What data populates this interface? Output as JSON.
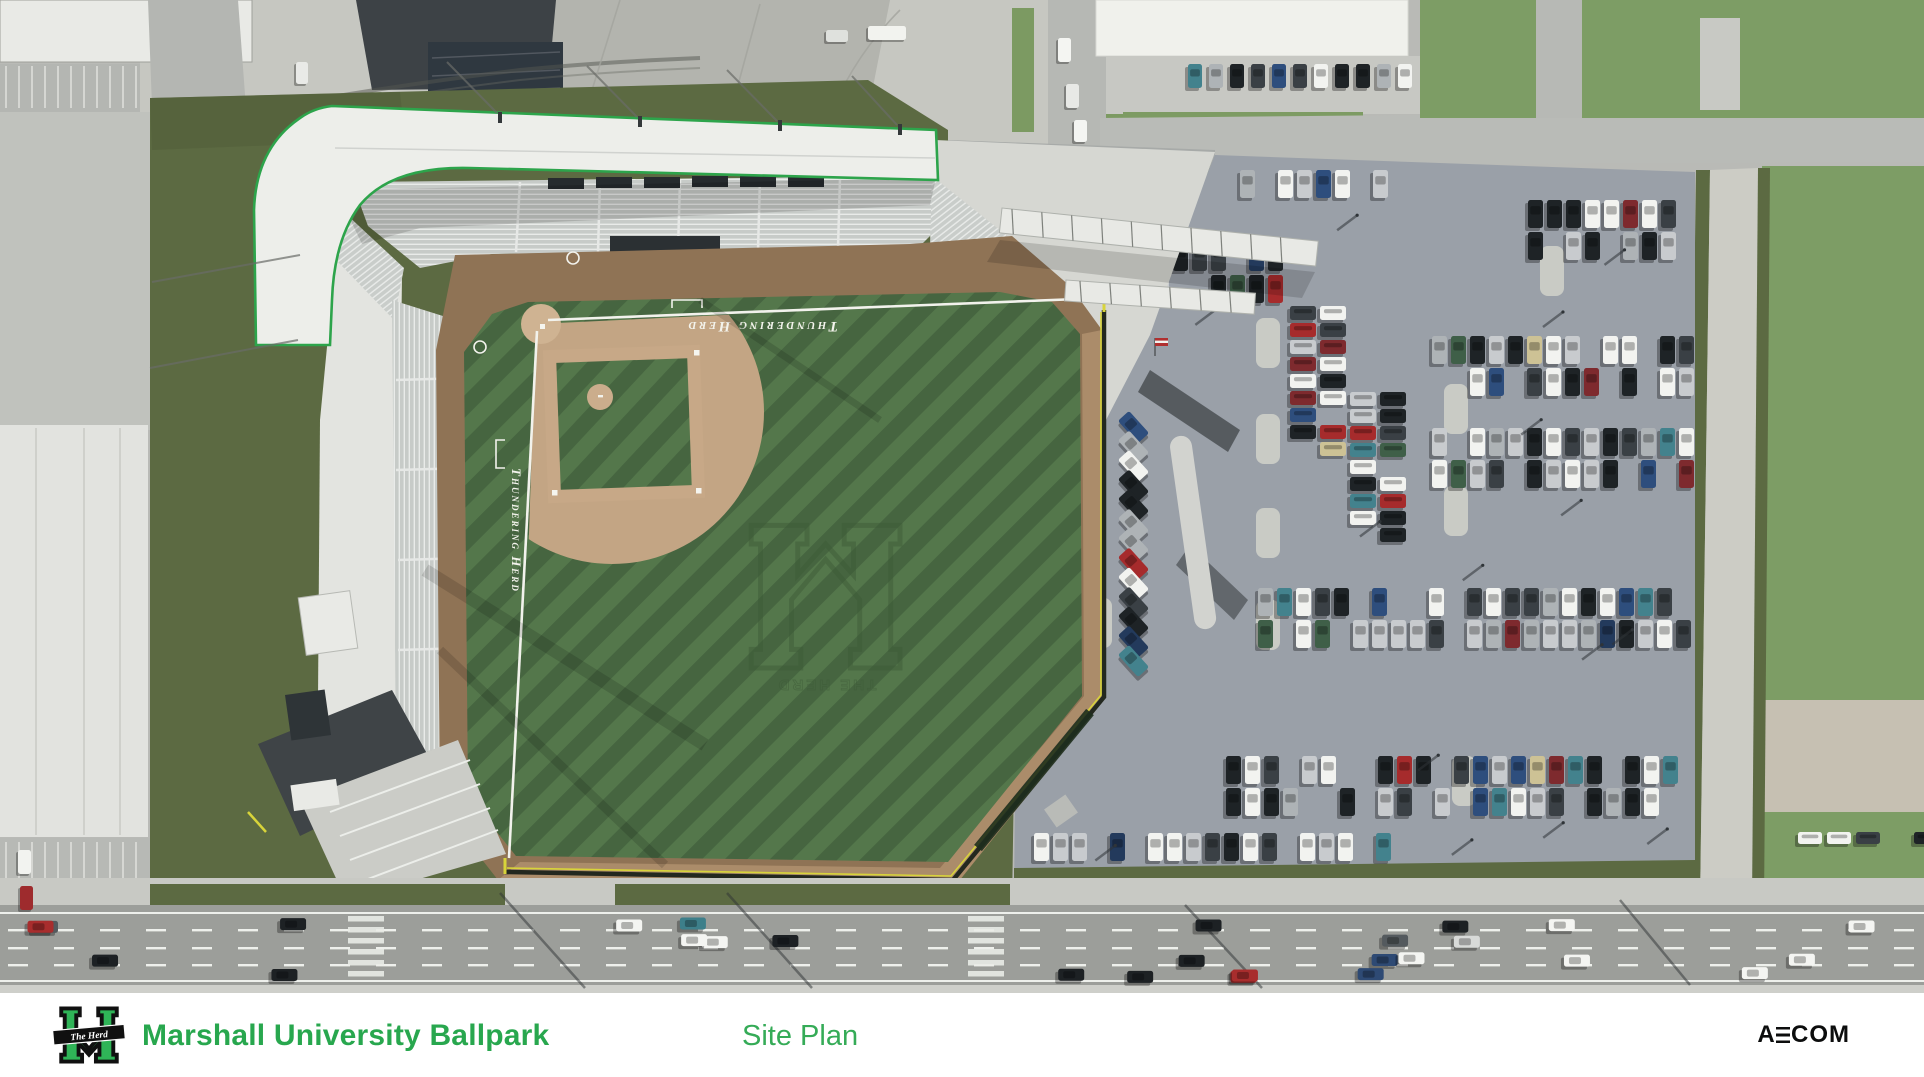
{
  "footer": {
    "title": "Marshall University Ballpark",
    "subtitle": "Site Plan",
    "brand_parts": [
      "A",
      "E",
      "COM"
    ],
    "logo_banner": "The Herd",
    "title_color": "#28a74e",
    "subtitle_color": "#35ab57",
    "brand_color": "#0c0d0d",
    "background": "#ffffff"
  },
  "field_texts": {
    "backstop": "Thundering Herd",
    "third_base_line": "Thundering Herd",
    "outfield_logo": "THE HERD"
  },
  "colors": {
    "accent_green": "#2da44b",
    "turf_light": "#54774b",
    "turf_dark": "#466540",
    "infield_dirt": "#c5a686",
    "warning_track": "#8f7355",
    "site_olive": "#5c6a42",
    "lot_asphalt": "#9aa0a8",
    "roof_white": "#edeeea",
    "photo_concrete": "#c6c7c1",
    "lawn": "#7d9d65",
    "fence_yellow": "#d8d43a"
  },
  "parking": {
    "bands": [
      {
        "x0": 1240,
        "x1": 1392,
        "y": 170,
        "rows": [
          0
        ]
      },
      {
        "x0": 1528,
        "x1": 1694,
        "y": 200,
        "rows": [
          0,
          32
        ]
      },
      {
        "x0": 1078,
        "x1": 1296,
        "y": 243,
        "rows": [
          0,
          32
        ]
      },
      {
        "x0": 1432,
        "x1": 1694,
        "y": 336,
        "rows": [
          0,
          32
        ]
      },
      {
        "x0": 1432,
        "x1": 1694,
        "y": 428,
        "rows": [
          0,
          32
        ]
      },
      {
        "x0": 1258,
        "x1": 1694,
        "y": 588,
        "rows": [
          0,
          32
        ]
      },
      {
        "x0": 1226,
        "x1": 1694,
        "y": 756,
        "rows": [
          0,
          32
        ]
      },
      {
        "x0": 1034,
        "x1": 1392,
        "y": 833,
        "rows": [
          0
        ]
      }
    ],
    "columns": [
      {
        "x": 1290,
        "y0": 306,
        "y1": 472
      },
      {
        "x": 1320,
        "y0": 306,
        "y1": 472
      },
      {
        "x": 1350,
        "y0": 392,
        "y1": 558
      },
      {
        "x": 1380,
        "y0": 392,
        "y1": 558
      }
    ],
    "apron_row": {
      "x0": 1188,
      "x1": 1398,
      "y": 64
    },
    "right_street_row": {
      "x0": 1798,
      "x1": 1914,
      "y": 832
    },
    "angled_row": {
      "x": 1126,
      "y0": 412,
      "count": 13,
      "step": 19.5,
      "angle": -42
    },
    "pads": [
      [
        1256,
        318
      ],
      [
        1256,
        414
      ],
      [
        1256,
        508
      ],
      [
        1444,
        384
      ],
      [
        1444,
        486
      ],
      [
        1088,
        236
      ],
      [
        1540,
        246
      ],
      [
        1452,
        756
      ],
      [
        1256,
        600
      ],
      [
        1088,
        598
      ]
    ],
    "pole_shadow_count": 16,
    "occupancy": 0.82,
    "palette": [
      [
        "#f2f3f0",
        6
      ],
      [
        "#c8cbce",
        3
      ],
      [
        "#aeb3b6",
        2
      ],
      [
        "#1e2326",
        4
      ],
      [
        "#3a4045",
        2
      ],
      [
        "#a62b2c",
        1
      ],
      [
        "#7e2a2e",
        1
      ],
      [
        "#43828d",
        1.2
      ],
      [
        "#2e4e7d",
        1
      ],
      [
        "#233a5c",
        1
      ],
      [
        "#cdc295",
        0.6
      ],
      [
        "#3f5f48",
        0.6
      ]
    ]
  },
  "traffic": {
    "lanes": [
      919,
      936,
      953,
      969
    ],
    "count": 27,
    "palette": [
      [
        "#f4f5f2",
        6
      ],
      [
        "#d8dad8",
        3
      ],
      [
        "#1d2124",
        3
      ],
      [
        "#545a5e",
        2
      ],
      [
        "#a82d2d",
        1.2
      ],
      [
        "#3d7f8a",
        1
      ],
      [
        "#c9b24a",
        0.5
      ],
      [
        "#2e4a74",
        0.8
      ]
    ],
    "extra_vehicles": [
      {
        "x": 1058,
        "y": 38,
        "w": 13,
        "h": 24,
        "f": "#f4f5f2"
      },
      {
        "x": 1066,
        "y": 84,
        "w": 13,
        "h": 24,
        "f": "#e8e9e6"
      },
      {
        "x": 1074,
        "y": 120,
        "w": 13,
        "h": 22,
        "f": "#f4f5f2"
      },
      {
        "x": 868,
        "y": 26,
        "w": 38,
        "h": 14,
        "f": "#f2f3ef"
      },
      {
        "x": 826,
        "y": 30,
        "w": 22,
        "h": 12,
        "f": "#dfe1dd"
      },
      {
        "x": 296,
        "y": 62,
        "w": 12,
        "h": 22,
        "f": "#e9eaE7"
      },
      {
        "x": 18,
        "y": 850,
        "w": 13,
        "h": 24,
        "f": "#f2f3f0"
      },
      {
        "x": 20,
        "y": 886,
        "w": 13,
        "h": 24,
        "f": "#9e2b2d"
      }
    ]
  },
  "people_regions": [
    {
      "x": 952,
      "y": 152,
      "w": 235,
      "h": 175,
      "count": 62
    },
    {
      "x": 520,
      "y": 246,
      "w": 400,
      "h": 16,
      "count": 24
    },
    {
      "x": 330,
      "y": 420,
      "w": 60,
      "h": 340,
      "count": 42
    },
    {
      "x": 300,
      "y": 760,
      "w": 170,
      "h": 120,
      "count": 26
    },
    {
      "x": 300,
      "y": 886,
      "w": 620,
      "h": 14,
      "count": 9
    }
  ],
  "trees": [
    {
      "x": 140,
      "y": 52,
      "s": 1.3
    },
    {
      "x": 164,
      "y": 86,
      "s": 0.9
    },
    {
      "x": 1448,
      "y": 66,
      "s": 1.5
    },
    {
      "x": 1500,
      "y": 30,
      "s": 1.0
    },
    {
      "x": 1466,
      "y": 118,
      "s": 0.9
    },
    {
      "x": 458,
      "y": 860,
      "s": 1.6
    },
    {
      "x": 494,
      "y": 888,
      "s": 1.1
    },
    {
      "x": 1046,
      "y": 880,
      "s": 1.4
    },
    {
      "x": 1136,
      "y": 872,
      "s": 1.7
    },
    {
      "x": 1242,
      "y": 878,
      "s": 1.5
    },
    {
      "x": 1416,
      "y": 872,
      "s": 1.8
    },
    {
      "x": 1522,
      "y": 880,
      "s": 1.6
    },
    {
      "x": 1608,
      "y": 874,
      "s": 1.4
    },
    {
      "x": 1777,
      "y": 250,
      "s": 1.2
    },
    {
      "x": 1906,
      "y": 368,
      "s": 1.1
    },
    {
      "x": 1888,
      "y": 140,
      "s": 1.0
    },
    {
      "x": 912,
      "y": 78,
      "s": 0.8
    }
  ],
  "houses": [
    {
      "x": 1558,
      "y": 0,
      "w": 125,
      "h": 40,
      "f": "#878c90"
    },
    {
      "x": 1612,
      "y": 42,
      "w": 120,
      "h": 52,
      "f": "#7b8084"
    },
    {
      "x": 1872,
      "y": 0,
      "w": 52,
      "h": 30,
      "f": "#53585c"
    },
    {
      "x": 1852,
      "y": 30,
      "w": 72,
      "h": 62,
      "f": "#45524c"
    },
    {
      "x": 1742,
      "y": 0,
      "w": 55,
      "h": 35,
      "f": "#6b7074"
    },
    {
      "x": 1786,
      "y": 190,
      "w": 70,
      "h": 80,
      "f": "#3a4045"
    },
    {
      "x": 1858,
      "y": 196,
      "w": 62,
      "h": 72,
      "f": "#32383d"
    },
    {
      "x": 1862,
      "y": 204,
      "w": 24,
      "h": 30,
      "f": "#2b3c54"
    },
    {
      "x": 1792,
      "y": 300,
      "w": 96,
      "h": 70,
      "f": "#75797d"
    },
    {
      "x": 1796,
      "y": 408,
      "w": 112,
      "h": 82,
      "f": "#40464b"
    },
    {
      "x": 1808,
      "y": 418,
      "w": 30,
      "h": 26,
      "f": "#2b3c54"
    },
    {
      "x": 1806,
      "y": 536,
      "w": 96,
      "h": 50,
      "f": "#7c8184"
    },
    {
      "x": 1800,
      "y": 596,
      "w": 100,
      "h": 46,
      "f": "#9b6f54"
    },
    {
      "x": 1788,
      "y": 650,
      "w": 118,
      "h": 52,
      "f": "#a97a58"
    },
    {
      "x": 1795,
      "y": 790,
      "w": 80,
      "h": 40,
      "f": "#b3b4ae"
    }
  ],
  "left_buildings": [
    {
      "x": 150,
      "y": 180,
      "w": 55,
      "h": 130,
      "f": "#33383b",
      "r": -4
    },
    {
      "x": 155,
      "y": 362,
      "w": 72,
      "h": 40,
      "f": "#23282b",
      "r": -7
    },
    {
      "x": 160,
      "y": 412,
      "w": 90,
      "h": 46,
      "f": "#1d2225",
      "r": -7
    },
    {
      "x": 168,
      "y": 470,
      "w": 85,
      "h": 40,
      "f": "#20262a",
      "r": -7
    },
    {
      "x": 175,
      "y": 520,
      "w": 95,
      "h": 58,
      "f": "#5e3a34",
      "r": -7
    },
    {
      "x": 185,
      "y": 596,
      "w": 80,
      "h": 74,
      "f": "#6e443c",
      "r": -7
    },
    {
      "x": 190,
      "y": 682,
      "w": 86,
      "h": 50,
      "f": "#1c2124",
      "r": -7
    },
    {
      "x": 198,
      "y": 744,
      "w": 90,
      "h": 52,
      "f": "#23282c",
      "r": -7
    },
    {
      "x": 205,
      "y": 808,
      "w": 92,
      "h": 44,
      "f": "#5f3b36",
      "r": -7
    }
  ],
  "fence_banners": [
    [
      1112,
      446
    ],
    [
      1116,
      668
    ]
  ]
}
